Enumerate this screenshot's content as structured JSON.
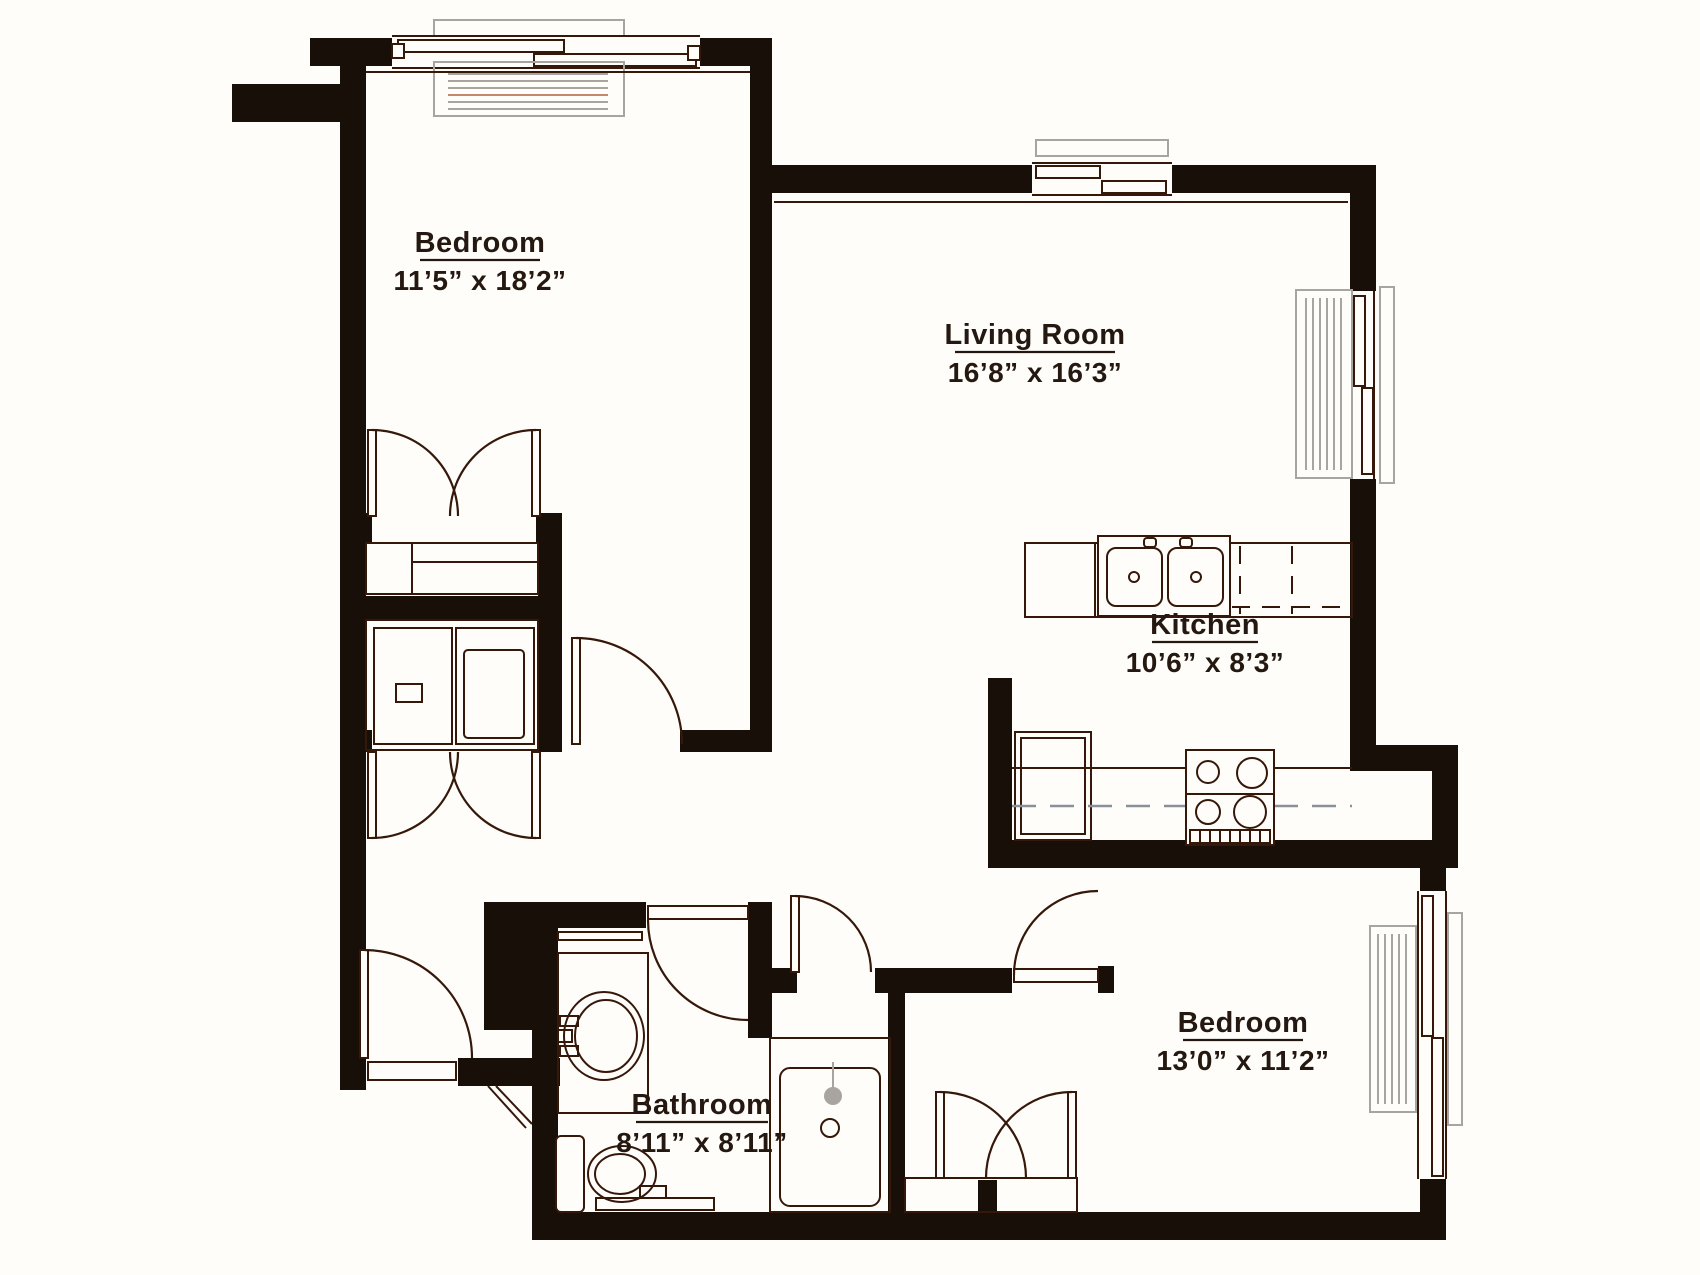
{
  "plan": {
    "title": "Two bedroom apartment floor plan",
    "background": "#fffdfa",
    "colors": {
      "wall": "#180f08",
      "line": "#35180a",
      "gray": "#a8a4a0",
      "accent": "#c48871",
      "ink": "#241810"
    },
    "rooms": [
      {
        "id": "bedroom-1",
        "name": "Bedroom",
        "dimensions": "11’5” x 18’2”"
      },
      {
        "id": "living-room",
        "name": "Living Room",
        "dimensions": "16’8” x 16’3”"
      },
      {
        "id": "kitchen",
        "name": "Kitchen",
        "dimensions": "10’6” x 8’3”"
      },
      {
        "id": "bathroom",
        "name": "Bathroom",
        "dimensions": "8’11” x 8’11”"
      },
      {
        "id": "bedroom-2",
        "name": "Bedroom",
        "dimensions": "13’0” x 11’2”"
      }
    ],
    "fixtures": [
      "double-basin-kitchen-sink",
      "range-stove",
      "refrigerator",
      "kitchen-counter",
      "vanity-sink",
      "toilet",
      "bathtub-shower",
      "washer-dryer",
      "closet-shelves",
      "radiator",
      "slider-window",
      "hinged-door",
      "french-doors"
    ]
  }
}
